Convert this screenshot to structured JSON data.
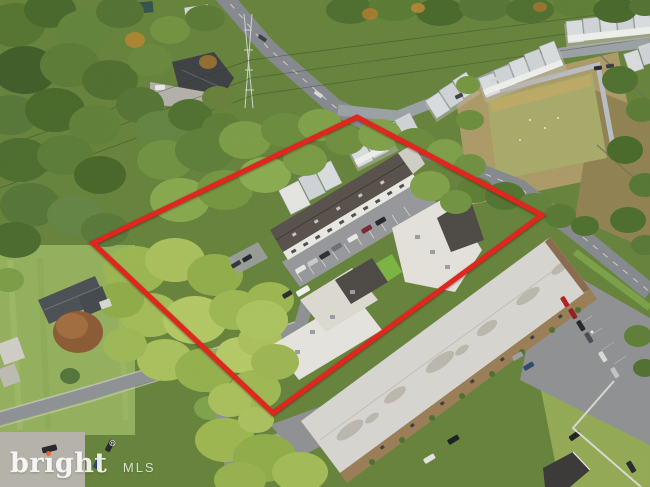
{
  "image_type": "aerial-drone-photograph",
  "watermark": {
    "brand_pre": "br",
    "brand_i": "ı",
    "brand_post": "ght",
    "reg": "®",
    "suffix": "MLS"
  },
  "colors": {
    "boundary": "#e0231a",
    "watermark_text": "#ffffff",
    "watermark_dot": "#f15d23",
    "pond_water": "#a7aa68",
    "road_asphalt": "#85898d",
    "subject_roof": "#57504a",
    "apartment_roof": "#d7d5d0",
    "canopy_green": "#6f9140",
    "lawn_green": "#93b05c"
  },
  "boundary_points": "93,243 357,117 542,215 273,413"
}
